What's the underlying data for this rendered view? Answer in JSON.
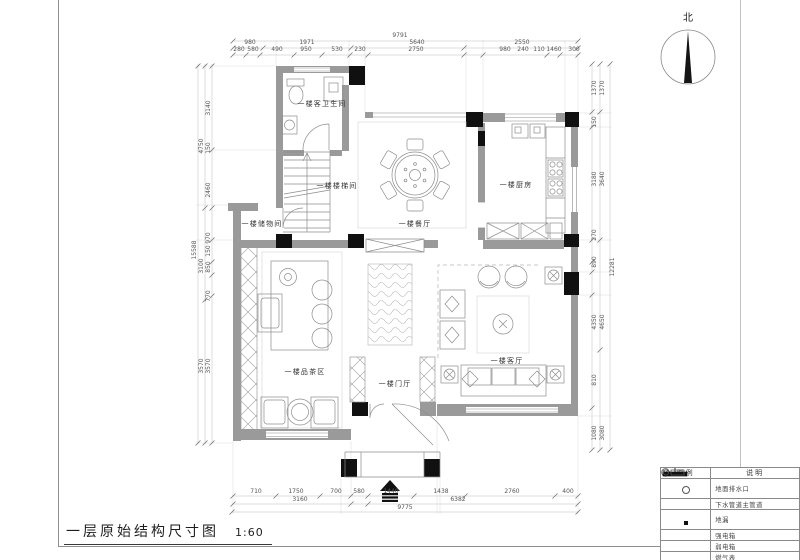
{
  "sheet": {
    "title": "一层原始结构尺寸图",
    "scale": "1:60",
    "north_label": "北"
  },
  "rooms": {
    "guest_bathroom": "一楼客卫生间",
    "stairwell": "一楼楼梯间",
    "storage": "一楼储物间",
    "dining": "一楼餐厅",
    "kitchen": "一楼厨房",
    "tea_area": "一楼品茶区",
    "entry_hall": "一楼门厅",
    "living_room": "一楼客厅"
  },
  "dimensions": {
    "top": {
      "outer": "9791",
      "mid": [
        "980",
        "1971",
        "5640",
        "2550"
      ],
      "inner": [
        "280",
        "580",
        "490",
        "950",
        "530",
        "230",
        "2750",
        "980",
        "240",
        "110",
        "1460",
        "300"
      ]
    },
    "left": {
      "outer": "15588",
      "mid": [
        "4750",
        "3100",
        "3570"
      ],
      "inner": [
        "3140",
        "150",
        "2460",
        "970",
        "150",
        "850",
        "770",
        "3570"
      ]
    },
    "right": {
      "outer": "12281",
      "mid": [
        "1370",
        "3640",
        "4650",
        "3080"
      ],
      "inner": [
        "1370",
        "150",
        "3180",
        "270",
        "890",
        "4350",
        "810",
        "1080"
      ]
    },
    "bottom": {
      "outer": "9775",
      "mid": [
        "3160",
        "6382"
      ],
      "inner": [
        "710",
        "1750",
        "700",
        "580",
        "1440",
        "1438",
        "2760",
        "400"
      ]
    }
  },
  "legend": {
    "col_symbol": "图例",
    "col_desc": "说明",
    "rows": [
      {
        "symbol": "drain-circle",
        "label": "地面排水口"
      },
      {
        "symbol": "pipe-circle-x",
        "label": "下水管道主管道"
      },
      {
        "symbol": "floor-drain-square",
        "label": "地漏"
      },
      {
        "symbol": "strong-power-box",
        "label": "强电箱"
      },
      {
        "symbol": "weak-power-box",
        "label": "弱电箱"
      },
      {
        "symbol": "gas-meter",
        "label": "燃气表"
      },
      {
        "symbol": "beam",
        "label": "梁"
      }
    ]
  }
}
